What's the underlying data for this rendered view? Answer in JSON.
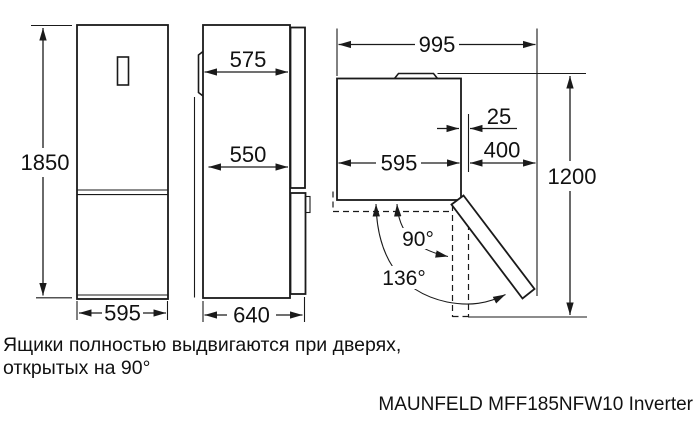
{
  "colors": {
    "line": "#1a1a1a",
    "background": "#ffffff"
  },
  "dimensions": {
    "front_height": "1850",
    "front_width": "595",
    "side_depth_top": "575",
    "side_depth_mid": "550",
    "side_depth_total": "640",
    "top_total_width": "995",
    "top_body_width": "595",
    "top_gap": "25",
    "top_clearance": "400",
    "top_depth_door_open": "1200",
    "angle_90": "90°",
    "angle_136": "136°"
  },
  "note": {
    "line1": "Ящики полностью выдвигаются при дверях,",
    "line2": "открытых на 90°"
  },
  "footer": {
    "model_label": "MAUNFELD MFF185NFW10 Inverter"
  }
}
